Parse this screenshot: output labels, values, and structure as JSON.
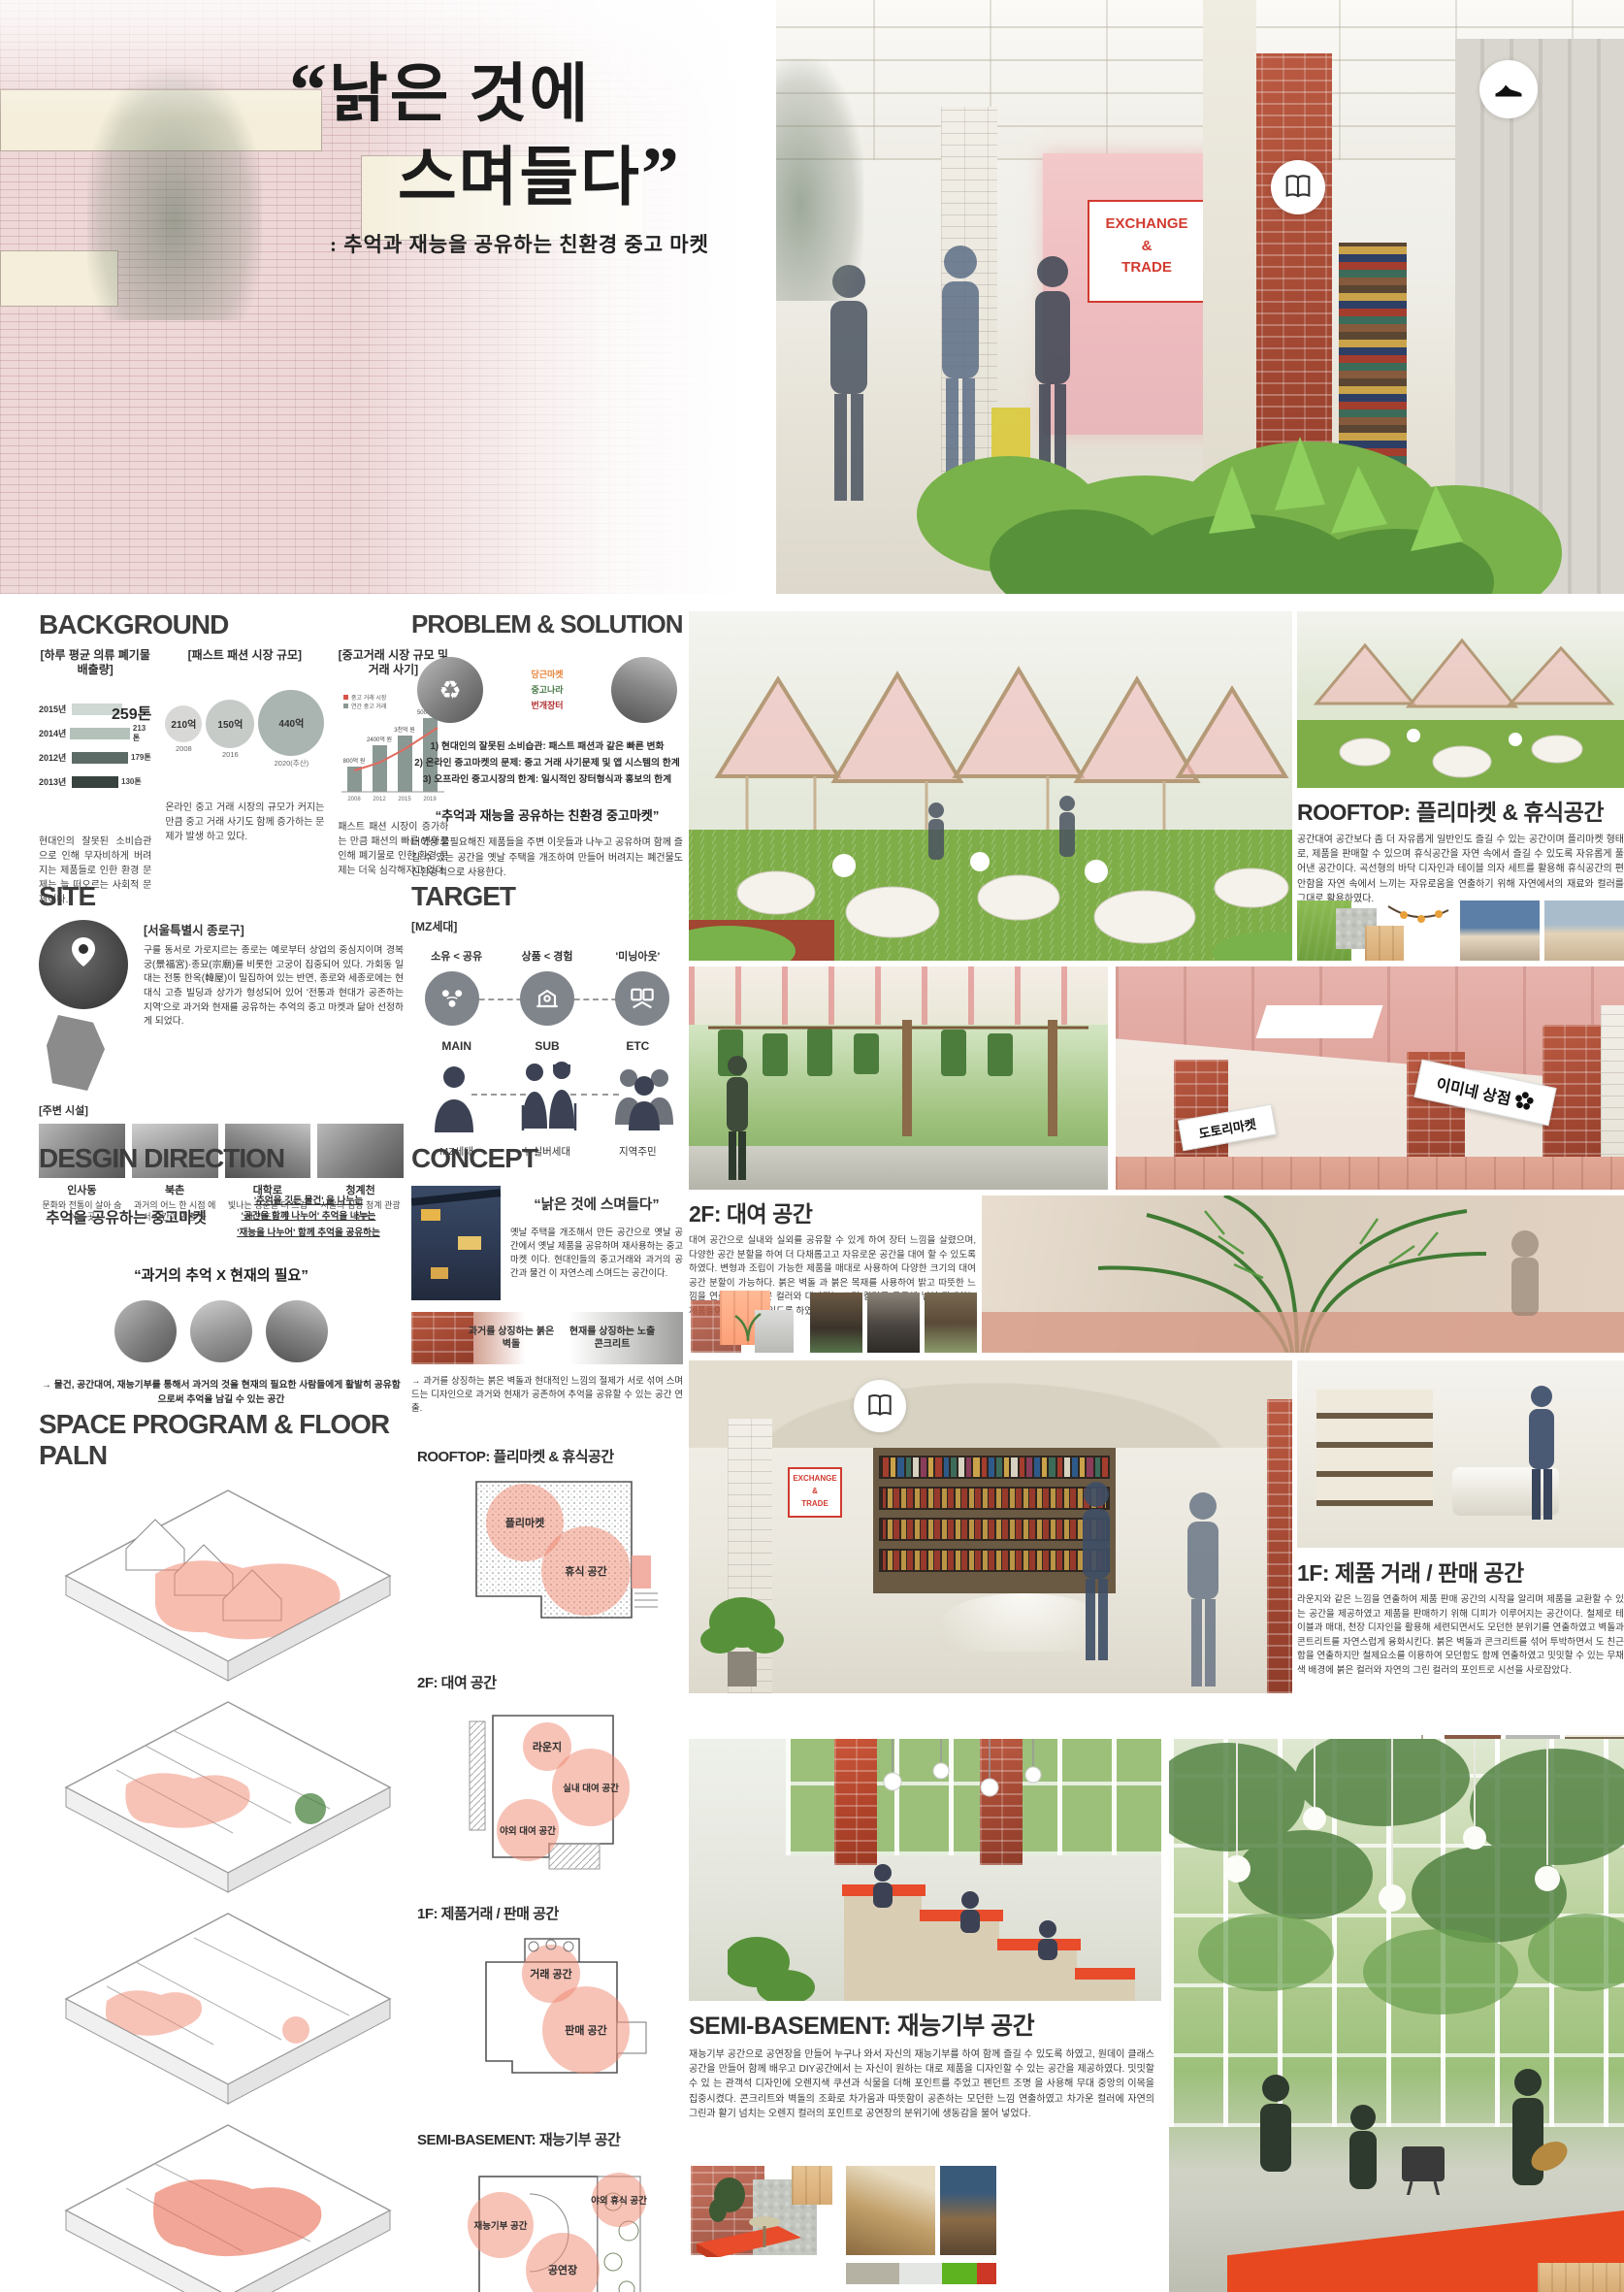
{
  "colors": {
    "accent_red": "#c8372d",
    "zone_pink": "#f0876f",
    "grass_green": "#76a93f",
    "brick_red": "#a04631",
    "palette_strip": [
      "#b5b2a3",
      "#e3e6e2",
      "#5eb321",
      "#cc3726"
    ]
  },
  "hero": {
    "open_quote": "“",
    "title_line1": "낡은 것에",
    "title_line2": "스며들다",
    "close_quote": "”",
    "subtitle": ": 추억과 재능을 공유하는 친환경 중고 마켓",
    "sign_lines": [
      "EXCHANGE",
      "&",
      "TRADE"
    ]
  },
  "background": {
    "title": "BACKGROUND",
    "chart1": {
      "type": "bar",
      "label": "[하루 평균 의류 폐기물 배출량]",
      "highlight": "259톤",
      "categories": [
        "2015년",
        "2014년",
        "2012년",
        "2013년"
      ],
      "values": [
        "259톤",
        "213톤",
        "179톤",
        "130톤"
      ]
    },
    "chart2": {
      "type": "bubble",
      "label": "[패스트 패션 시장 규모]",
      "bubbles": [
        {
          "value": "210억",
          "year": "2008"
        },
        {
          "value": "150억",
          "year": "2016"
        },
        {
          "value": "440억",
          "year": "2020(추산)"
        }
      ]
    },
    "chart3": {
      "type": "bar-line",
      "label": "[중고거래 시장 규모 및 거래 사기]",
      "legend": [
        "중고 거래 시장",
        "연간 중고 거래"
      ],
      "categories": [
        "2008",
        "2012",
        "2015",
        "2019"
      ],
      "values": [
        "800억 원",
        "2400억 원",
        "3천억 원",
        "5000억 원"
      ]
    },
    "captions": [
      "현대인의 잘못된 소비습관 으로 인해 무자비하게 버려지는 제품들로 인한 환경 문제는 늘 떠오르는 사회적 문제이다.",
      "온라인 중고 거래 시장의 규모가 커지는 만큼 중고 거래 사기도 함께 증가하는 문제가 발생 하고 있다.",
      "패스트 패션 시장이 증가하는 만큼 패션의 빠른 변화로 인해 폐기물로 인한 환경 문제는 더욱 심각해지고 있다."
    ]
  },
  "problem": {
    "title": "PROBLEM & SOLUTION",
    "apps": [
      "당근마켓",
      "중고나라",
      "번개장터"
    ],
    "items": [
      "1) 현대인의 잘못된 소비습관: 패스트 패션과 같은 빠른 변화",
      "2) 온라인 중고마켓의 문제: 중고 거래 사기문제 및 앱 시스템의 한계",
      "3) 오프라인 중고시장의 한계: 일시적인 장터형식과 홍보의 한계"
    ],
    "quote": "“추억과 재능을 공유하는 친환경 중고마켓”",
    "text": "더이상 불필요해진 제품들을 주변 이웃들과 나누고 공유하며 함께 즐길 수 있는 공간을 옛날 주택을 개조하여 만들어 버려지는 폐건물도 친환경적으로 사용한다."
  },
  "site": {
    "title": "SITE",
    "location": "[서울특별시 종로구]",
    "text": "구를 동서로 가로지르는 종로는 예로부터 상업의 중심지이며 경복궁(景福宮)·종묘(宗廟)를 비롯한 고궁이 집중되어 있다. 가회동 일대는 전통 한옥(韓屋)이 밀집하여 있는 반면, 종로와 세종로에는 현대식 고층 빌딩과 상가가 형성되어 있어 '전통과 현대가 공존하는 지역'으로 과거와 현재를 공유하는 추억의 중고 마켓과 닮아 선정하게 되었다.",
    "facilities_label": "[주변 시설]",
    "facilities": [
      {
        "name": "인사동",
        "desc": "문화와 전통이 살아 숨쉬는 곳"
      },
      {
        "name": "북촌",
        "desc": "과거의 어느 한 시점 에서 시간이 멈춘 곳"
      },
      {
        "name": "대학로",
        "desc": "빛나는 청춘을 더 뜨겁게 만드는 곳"
      },
      {
        "name": "청계천",
        "desc": "서울의 심장 청계 관광특구"
      }
    ]
  },
  "target": {
    "title": "TARGET",
    "group": "[MZ세대]",
    "traits": [
      "소유 < 공유",
      "상품 < 경험",
      "'미닝아웃'"
    ],
    "tiers": [
      {
        "rank": "MAIN",
        "name": "MZ세대"
      },
      {
        "rank": "SUB",
        "name": "뉴실버세대"
      },
      {
        "rank": "ETC",
        "name": "지역주민"
      }
    ]
  },
  "direction": {
    "title": "DESGIN DIRECTION",
    "headline": "추억을  공유하는 중고마켓",
    "share_lines": [
      "'추억을 깃든 물건' 을 나누는",
      "'공간을 함께 나누어' 추억을 나누는",
      "'재능을 나누어' 함께 추억을 공유하는"
    ],
    "quote": "“과거의 추억 X 현재의 필요”",
    "conclusion": "→ 물건, 공간대여, 재능기부를 통해서 과거의 것을 현재의 필요한 사람들에게 활발히 공유함으로써 추억을 남길 수 있는 공간"
  },
  "concept": {
    "title": "CONCEPT",
    "quote": "“낡은 것에 스며들다”",
    "text": "옛날 주택을 개조해서 만든 공간으로 옛날 공간에서 옛날 제품을 공유하며 재사용하는 중고마켓 이다. 현대인들의 중고거래와 과거의 공간과 물건 이 자연스레 스며드는 공간이다.",
    "material_past": "과거를 상징하는 붉은 벽돌",
    "material_present": "현재를 상징하는 노출 콘크리트",
    "conclusion": "→ 과거를 상징하는 붉은 벽돌과 현대적인 느낌의 절제가 서로 섞여 스며드는 디자인으로 과거와 현재가 공존하여 추억을 공유할 수 있는 공간 연출."
  },
  "space_program": {
    "title": "SPACE PROGRAM & FLOOR PALN",
    "plans": [
      {
        "title": "ROOFTOP: 플리마켓 & 휴식공간",
        "areas": [
          "플리마켓",
          "휴식 공간"
        ]
      },
      {
        "title": "2F: 대여 공간",
        "areas": [
          "라운지",
          "실내 대여 공간",
          "야외 대여 공간"
        ]
      },
      {
        "title": "1F: 제품거래 / 판매 공간",
        "areas": [
          "거래 공간",
          "판매 공간"
        ]
      },
      {
        "title": "SEMI-BASEMENT: 재능기부 공간",
        "areas": [
          "재능기부 공간",
          "공연장",
          "야외 휴식 공간"
        ]
      }
    ]
  },
  "zones": {
    "rooftop": {
      "title": "ROOFTOP: 플리마켓 & 휴식공간",
      "text": "공간대여 공간보다 좀 더 자유롭게 일반인도 즐길 수 있는 공간이며 플리마켓 형태로, 제품을 판매할 수 있으며 휴식공간을 자연 속에서 즐길 수 있도록 자유롭게 풀어낸 공간이다. 곡선형의 바닥 디자인과 테이블 의자 세트를 활용해 휴식공간의 편안함을 자연 속에서 느끼는 자유로움을 연출하기 위해 자연에서의 재료와 컬러를 그대로 활용하였다."
    },
    "f2": {
      "title": "2F: 대여 공간",
      "banner_left": "도토리마켓",
      "banner_right": "이미네 상점",
      "text": "대여 공간으로 실내와 실외를 공유할 수 있게 하여 장터 느낌을 살렸으며, 다양한 공간 분할을 하여 더 다채롭고고 자유로운 공간을 대여 할 수 있도록 하였다. 변형과 조립이 가능한 제품을 매대로 사용하여 다양한 크기의 대여 공간 분할이 가능하다. 붉은 벽돌 과 붉은 목재를 사용하여 밝고 따뜻한 느낌을 연출하였고 붉은 컬러와 대비되는 그린 컬러를 곳곳에 넣어 판매하는 제품들이 눈에 띌 수 있도록 하였다."
    },
    "f1": {
      "title": "1F: 제품 거래 / 판매 공간",
      "text": "라운지와 같은 느낌을 연출하여 제품 판매 공간의 시작을 알리며 제품을 교환할 수 있는 공간을 제공하였고 제품을 판매하기 위해 디피가 이루어지는 공간이다. 철제로 테이블과 매대, 천장 디자인을 활용해 세련되면서도 모던한 분위기를 연출하였고 벽돌과 콘트리트를 자연스럽게 융화시킨다. 붉은 벽돌과 콘크리트를 섞어 투박하면서 도 친근함을 연출하지만 철제요소를 이용하여 모던함도 함께 연출하였고 밋밋할 수 있는 무채색 배경에 붉은 컬러와 자연의 그린 컬러의 포인트로 시선을 사로잡았다."
    },
    "basement": {
      "title": "SEMI-BASEMENT: 재능기부 공간",
      "text": "재능기부 공간으로 공연장을 만들어 누구나 와서 자신의 재능기부를 하여 함께 즐길 수 있도록 하였고, 원데이 클래스 공간을 만들어 함께 배우고 DIY공간에서 는 자신이 원하는 대로 제품을 디자인할 수 있는 공간을 제공하였다. 밋밋할 수 있 는 관객석 디자인에 오렌지색 쿠션과 식물을 더해 포인트를 주었고 펜던트 조명 을 사용해 무대 중앙의 이목을 집중시켰다. 콘크리트와 벽돌의 조화로 차가움과 따뜻함이 공존하는 모던한 느낌 연출하였고 차가운 컬러에 자연의 그린과 활기 넘치는 오렌지 컬러의 포인트로 공연장의 분위기에 생동감을 불어 넣었다."
    }
  }
}
